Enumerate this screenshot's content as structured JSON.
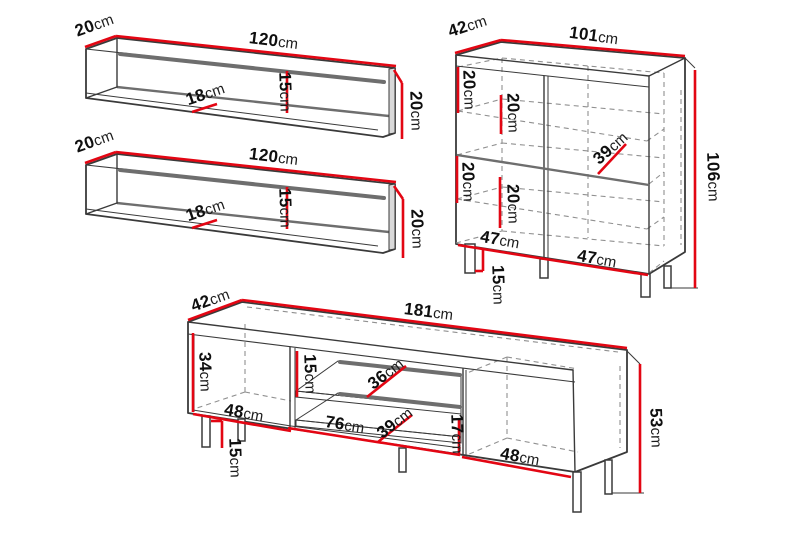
{
  "unit": "cm",
  "colors": {
    "dimension": "#e30613",
    "outline": "#3a3a3a",
    "shade": "#6e6e6e",
    "dash": "#909090"
  },
  "figures": [
    {
      "id": "wall-shelf-1",
      "type": "wall shelf"
    },
    {
      "id": "wall-shelf-2",
      "type": "wall shelf"
    },
    {
      "id": "sideboard-cabinet",
      "type": "sideboard"
    },
    {
      "id": "tv-stand",
      "type": "tv bench"
    }
  ],
  "labels": {
    "s1_depth": "20",
    "s1_width": "120",
    "s1_shelf_depth": "18",
    "s1_back_height": "15",
    "s1_end_height": "20",
    "s2_depth": "20",
    "s2_width": "120",
    "s2_shelf_depth": "18",
    "s2_back_height": "15",
    "s2_end_height": "20",
    "cab_depth": "42",
    "cab_width": "101",
    "cab_gap_top_left": "20",
    "cab_gap_top_inner": "20",
    "cab_shelf_depth": "39",
    "cab_height": "106",
    "cab_gap_bottom_left": "20",
    "cab_gap_bottom_inner": "20",
    "cab_door_left": "47",
    "cab_door_right": "47",
    "cab_leg_height": "15",
    "tv_depth": "42",
    "tv_width": "181",
    "tv_left_height": "34",
    "tv_left_width": "48",
    "tv_leg_height": "15",
    "tv_top_gap": "15",
    "tv_shelf_depth": "36",
    "tv_mid_width": "76",
    "tv_lower_shelf_depth": "39",
    "tv_bottom_gap": "17",
    "tv_right_width": "48",
    "tv_height": "53"
  }
}
